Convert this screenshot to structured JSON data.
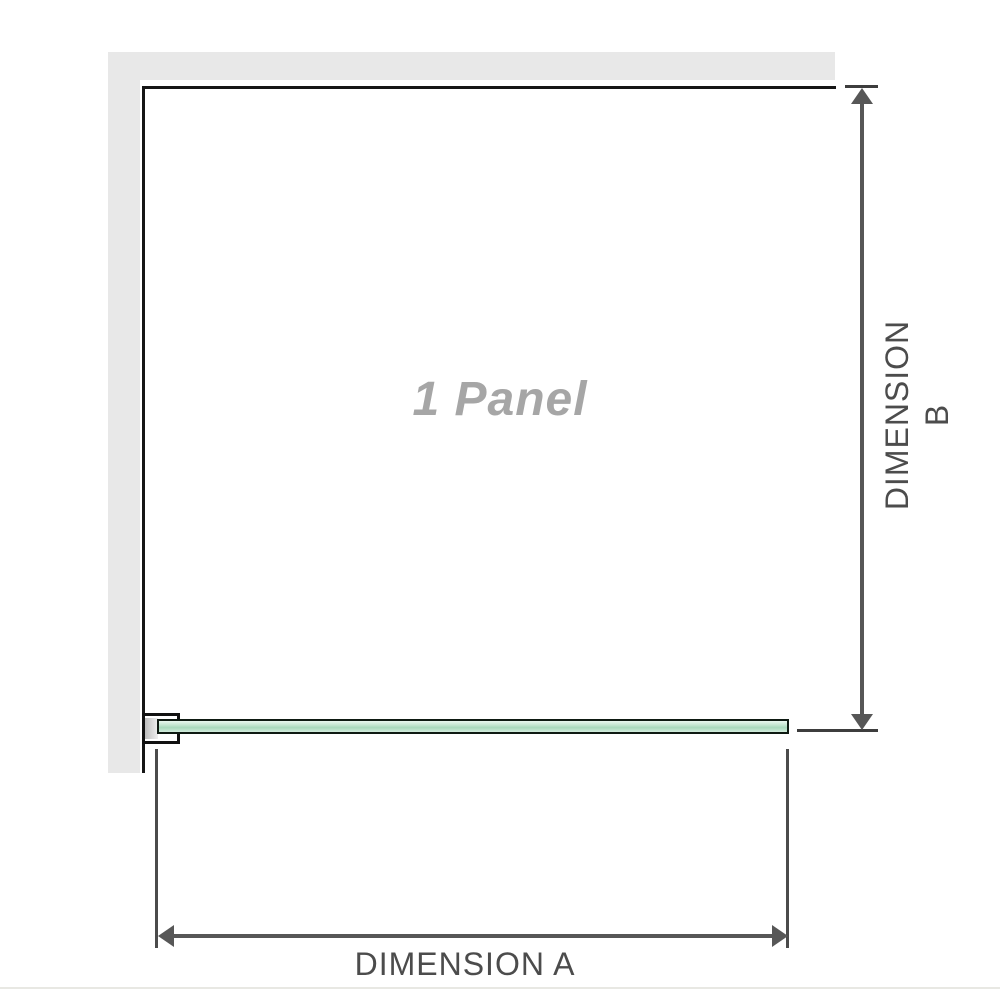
{
  "diagram": {
    "panel_label": "1 Panel",
    "dimension_a_label": "DIMENSION A",
    "dimension_b_label": "DIMENSION B"
  },
  "colors": {
    "wall-gray": "#e8e8e8",
    "edge-black": "#161616",
    "glass-border": "#0e1a12",
    "glass-a": "#eaf7f0",
    "glass-b": "#c6e7d2",
    "glass-c": "#a8d9bc",
    "glass-d": "#d2ecdd",
    "dim-line": "#575757",
    "tick": "#3d3d3d",
    "ext-line": "#4b4b4b",
    "label-gray": "#4c4c4c",
    "panel-text": "#a6a6a6",
    "divider": "#e8e8e3",
    "bg": "#ffffff"
  }
}
